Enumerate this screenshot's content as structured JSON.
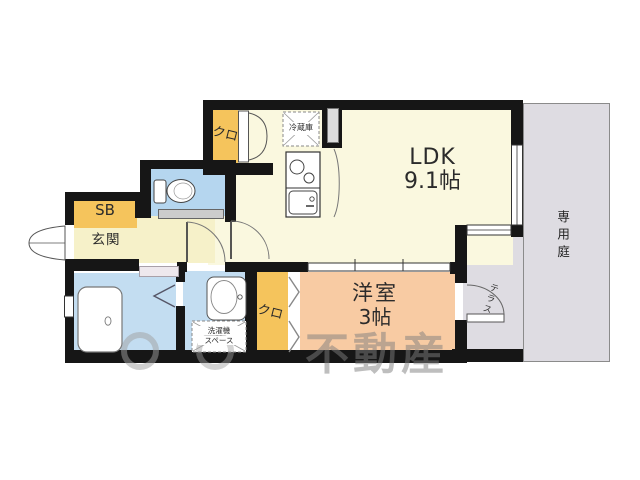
{
  "floorplan": {
    "rooms": {
      "ldk": {
        "name": "LDK",
        "area": "9.1帖"
      },
      "western_room": {
        "name": "洋室",
        "area": "3帖"
      },
      "entrance": {
        "name": "玄関"
      },
      "shoe_box": {
        "name": "SB"
      },
      "closet_upper": {
        "name": "クロ"
      },
      "closet_lower": {
        "name": "クロ"
      },
      "private_garden": {
        "name": "専用庭"
      },
      "terrace": {
        "name": "テラス"
      }
    },
    "fixtures": {
      "refrigerator": {
        "name": "冷蔵庫"
      },
      "washer_space": {
        "line1": "洗濯機",
        "line2": "スペース"
      }
    },
    "watermark": {
      "text": "不動産"
    },
    "colors": {
      "wall": "#161616",
      "ldk_cream": "#faf8df",
      "hall_cream": "#f6f1c9",
      "closet_orange": "#f5c45c",
      "wet_area_blue": "#c3ddf1",
      "bedroom_peach": "#f8cba3",
      "outdoor_gray": "#dedce2"
    }
  }
}
